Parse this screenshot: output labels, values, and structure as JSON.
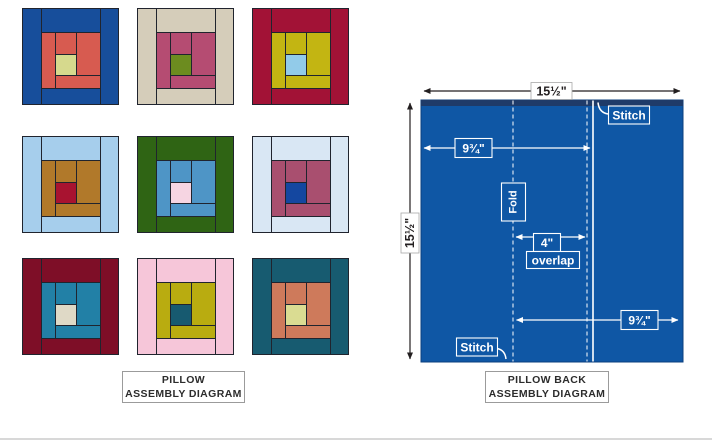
{
  "captions": {
    "left_line1": "PILLOW",
    "left_line2": "ASSEMBLY DIAGRAM",
    "right_line1": "PILLOW BACK",
    "right_line2": "ASSEMBLY DIAGRAM"
  },
  "seam_color": "#20242e",
  "blocks": [
    {
      "position": "row-1-col-1",
      "outer": "#174e9b",
      "middle": "#d75b50",
      "center": "#d6d98d"
    },
    {
      "position": "row-1-col-2",
      "outer": "#d5cdba",
      "middle": "#b54c72",
      "center": "#6c8c1f"
    },
    {
      "position": "row-1-col-3",
      "outer": "#a21236",
      "middle": "#c3b512",
      "center": "#92cbe9"
    },
    {
      "position": "row-2-col-1",
      "outer": "#a6ceec",
      "middle": "#b1792a",
      "center": "#a81330"
    },
    {
      "position": "row-2-col-2",
      "outer": "#2f6414",
      "middle": "#4e95c6",
      "center": "#f6d5e2"
    },
    {
      "position": "row-2-col-3",
      "outer": "#d9e7f4",
      "middle": "#a94f6f",
      "center": "#1447a0"
    },
    {
      "position": "row-3-col-1",
      "outer": "#7e0e27",
      "middle": "#2280a6",
      "center": "#dfd9c6"
    },
    {
      "position": "row-3-col-2",
      "outer": "#f6c6d9",
      "middle": "#b9ac10",
      "center": "#175a70"
    },
    {
      "position": "row-3-col-3",
      "outer": "#175b70",
      "middle": "#ce7a5b",
      "center": "#dadc92"
    }
  ],
  "back_diagram": {
    "fabric_color": "#0f57a5",
    "hem_band_color": "#1f3b69",
    "width_label": "15½\"",
    "height_label": "15½\"",
    "top_offset_label": "9¾\"",
    "bottom_offset_label": "9¾\"",
    "overlap_value": "4\"",
    "overlap_word": "overlap",
    "fold_label": "Fold",
    "stitch_top_label": "Stitch",
    "stitch_bottom_label": "Stitch"
  }
}
